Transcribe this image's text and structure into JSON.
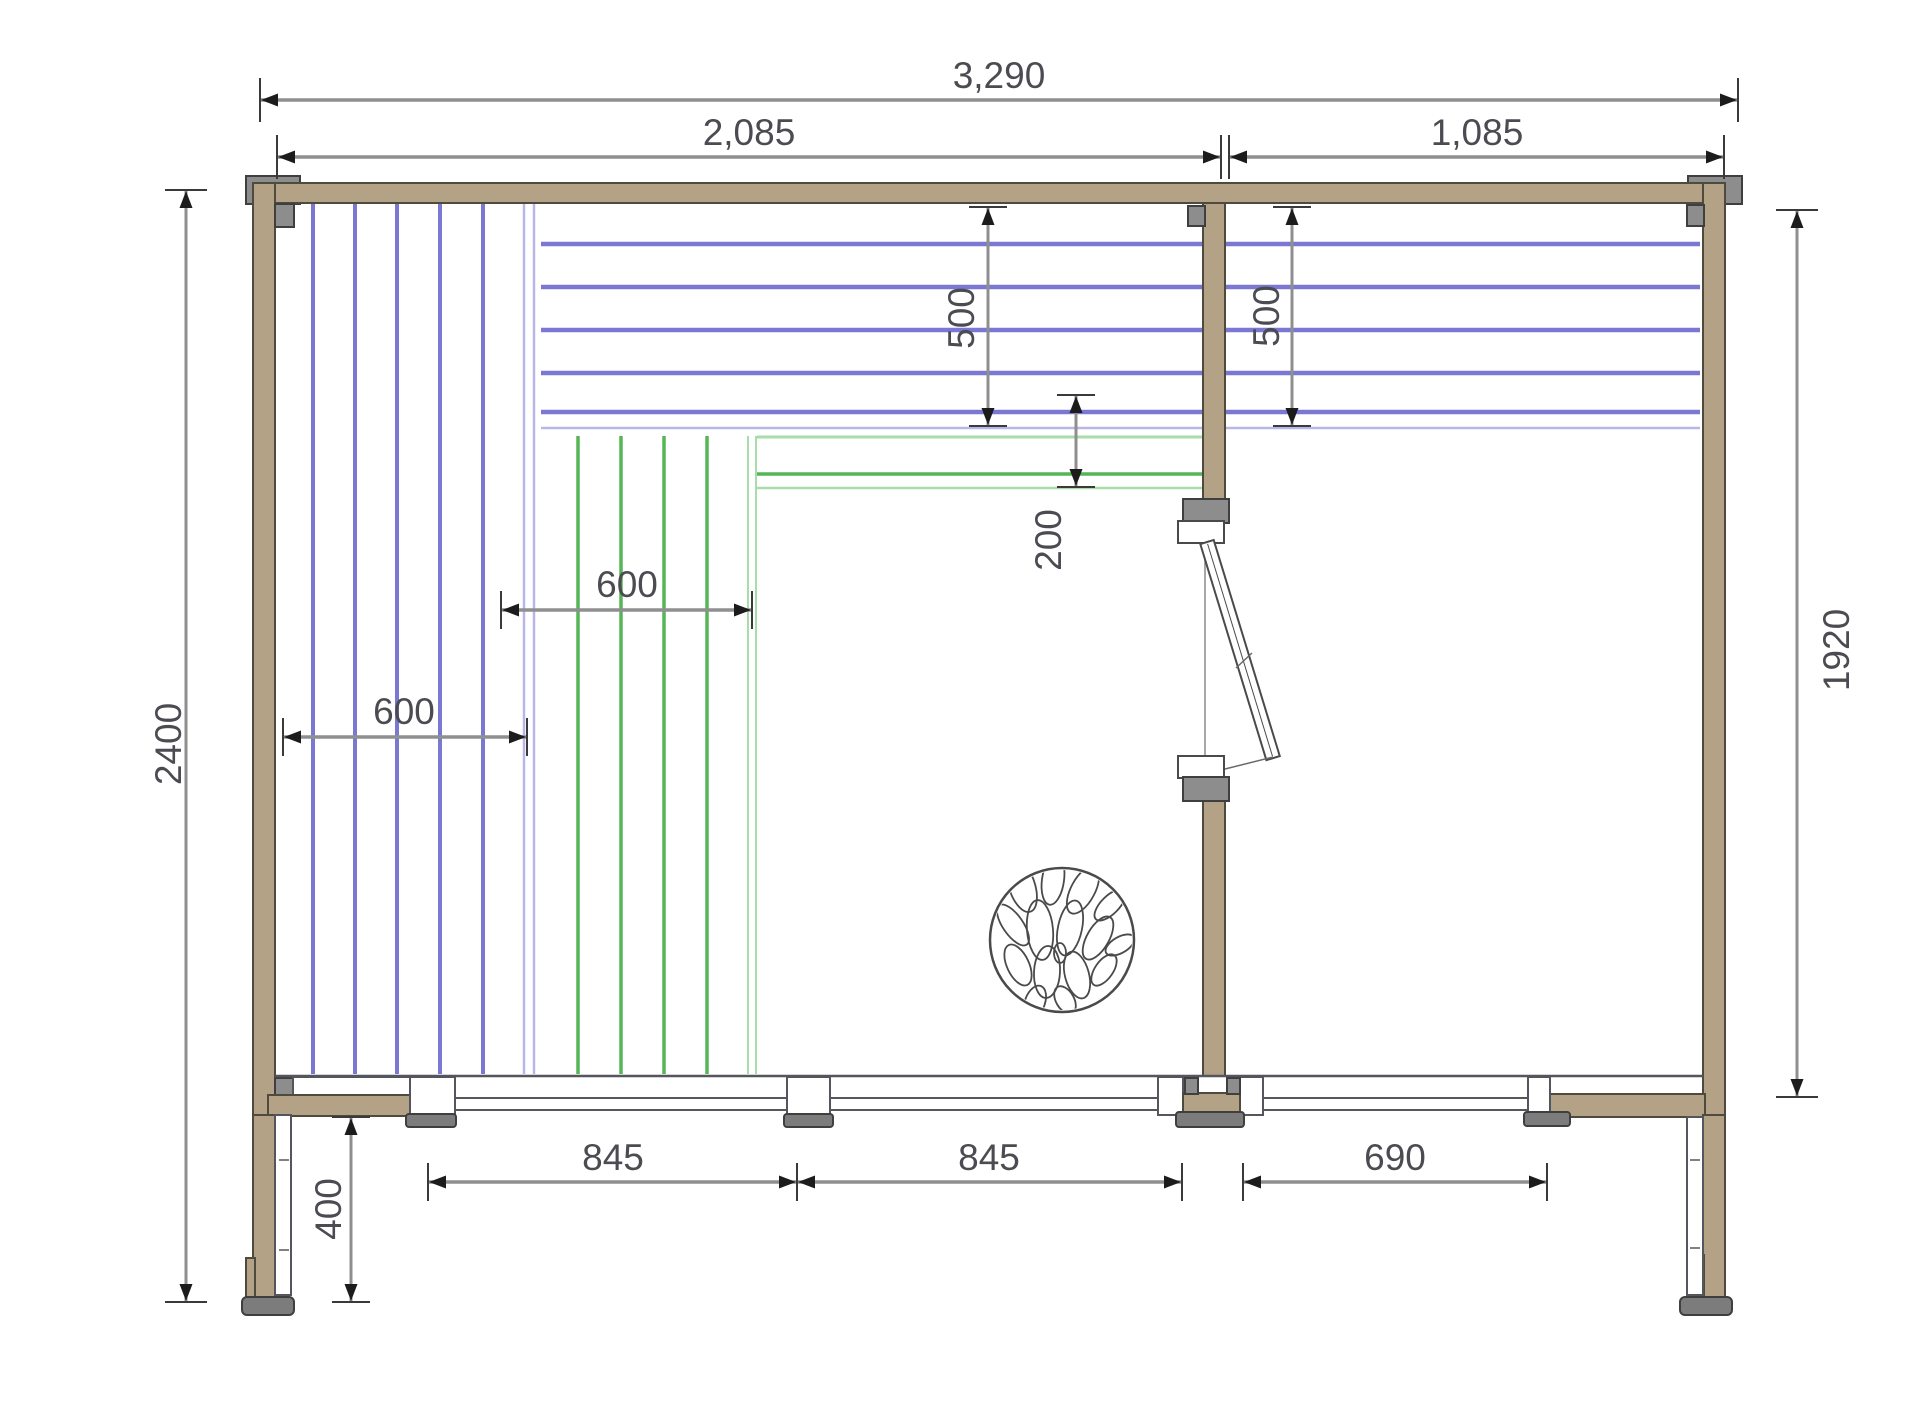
{
  "plan": {
    "dim_labels": {
      "overall_width": "3,290",
      "left_width": "2,085",
      "right_width": "1,085",
      "total_height": "2400",
      "right_height": "1920",
      "left_500": "500",
      "right_500": "500",
      "depth_200": "200",
      "green_600": "600",
      "blue_600": "600",
      "win_845_left": "845",
      "win_845_mid": "845",
      "win_690": "690",
      "base_400": "400"
    },
    "colors": {
      "wall_fill": "#b4a287",
      "wall_stroke": "#4e4a3d",
      "post_gray": "#8d8d8d",
      "post_gray_dark": "#7c7c7c",
      "post_stroke": "#3f3f3f",
      "dim_line": "#8f8f8f",
      "dim_tick": "#3a3a3a",
      "dim_arrow": "#1c1c1c",
      "dim_text": "#4b4b52",
      "panel_blue": "#7b78d4",
      "panel_blue_light": "#b9b7e8",
      "panel_green": "#56b556",
      "panel_green_light": "#a8dca8",
      "glazing_stroke": "#55555e",
      "heater_stroke": "#4a4a4a",
      "door_stroke": "#4a4a4a",
      "background": "#ffffff"
    }
  }
}
